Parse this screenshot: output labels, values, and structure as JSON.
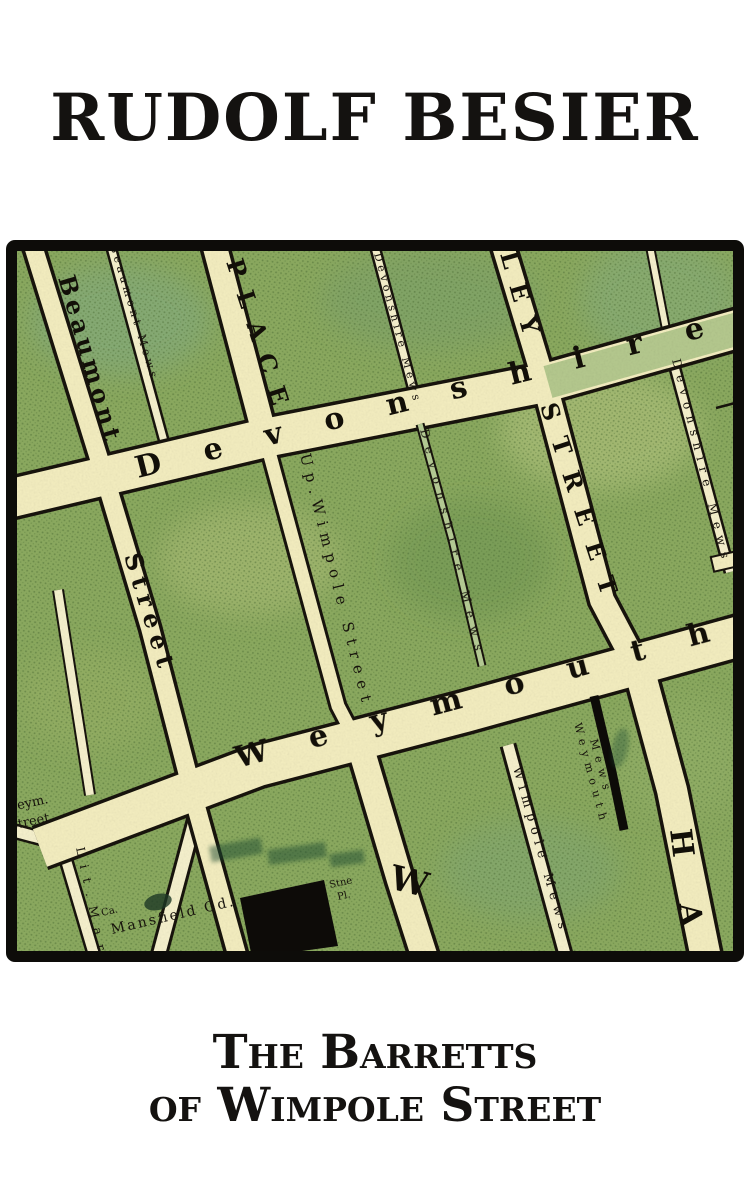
{
  "cover": {
    "author": "RUDOLF BESIER",
    "title_line1": "The Barretts",
    "title_line2": "of Wimpole Street"
  },
  "map": {
    "streets": {
      "beaumont": "Beaumont",
      "beaumont_lower": "Street",
      "beaumont_mews": "Beaumont Mews",
      "devonshire_place": "PLACE",
      "devonshire": "Devonshire",
      "up_wimpole": "Up.Wimpole Street",
      "harley_upper": "LEY",
      "harley_mid": "STREET",
      "harley_lower": "HA",
      "weymouth": "Weymouth",
      "wimpole_initial": "W",
      "wimpole_mews": "Wimpole Mews",
      "weymouth_mews_1": "Weymouth",
      "weymouth_mews_2": "Mews",
      "devonshire_mews_top": "Devonshire Mews",
      "devonshire_mews_mid": "Devonshire Mews",
      "devonshire_mews_east": "Devonshire Mews",
      "weym_1": "Weym.",
      "weym_2": "Street",
      "lit_mar": "Lit.Mar",
      "mansfield": "Mansfield Gd.",
      "ca": "Ca.",
      "stne_1": "Stne",
      "stne_2": "Pl."
    }
  },
  "colors": {
    "paper": "#ffffff",
    "ink": "#141210",
    "map_green": "#8cab60",
    "street_cream": "#f4eec0",
    "street_tint": "#b5c98e",
    "line_black": "#17130c"
  }
}
